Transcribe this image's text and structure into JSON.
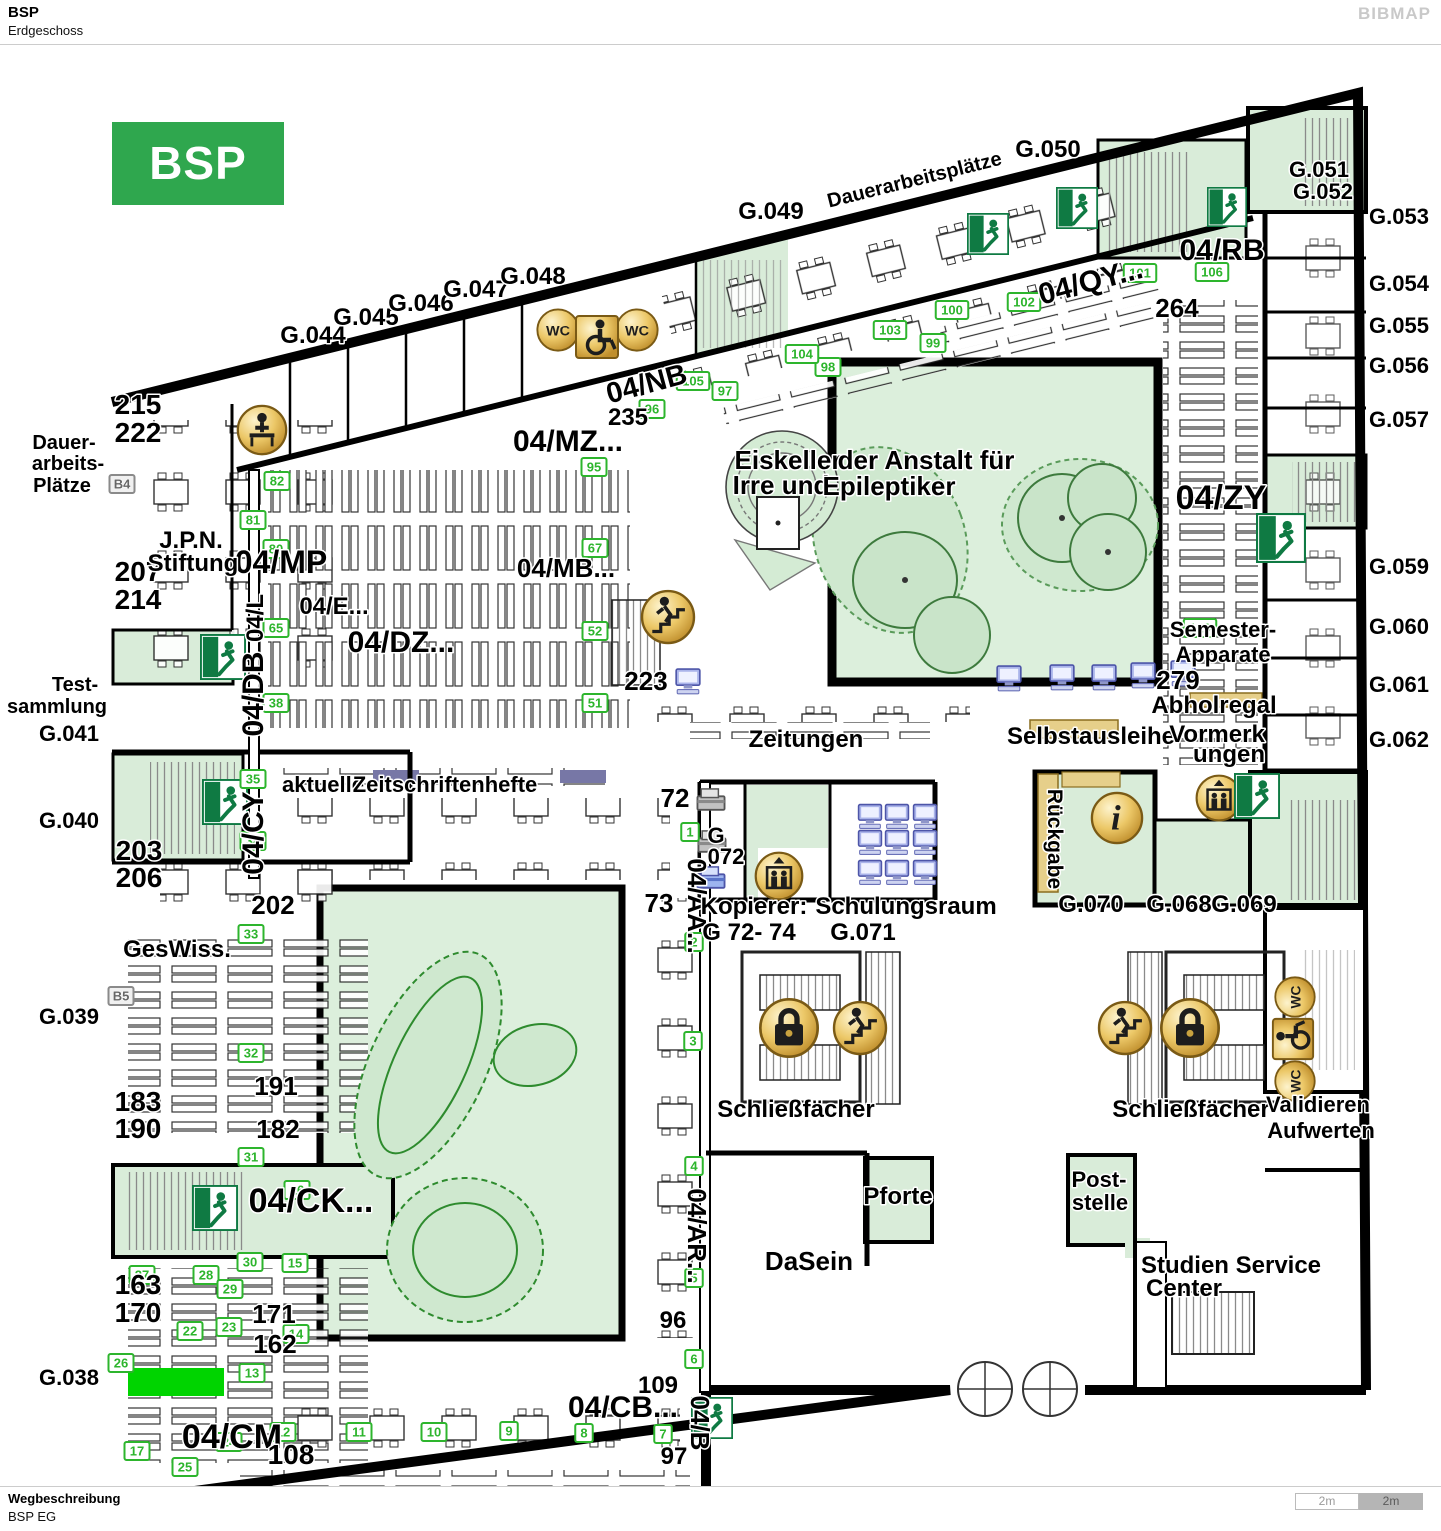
{
  "header": {
    "title": "BSP",
    "subtitle": "Erdgeschoss",
    "brand": "BIBMAP"
  },
  "footer": {
    "label": "Wegbeschreibung",
    "value": "BSP EG",
    "scale_left": "2m",
    "scale_right": "2m"
  },
  "map": {
    "title_box": {
      "text": "BSP EG",
      "color": "#2fa74e"
    },
    "highlight": {
      "x": 128,
      "y": 1368,
      "w": 96,
      "h": 28,
      "color": "#00d400"
    },
    "labels": [
      {
        "t": "G.044",
        "x": 313,
        "y": 343,
        "s": 24
      },
      {
        "t": "G.045",
        "x": 366,
        "y": 325,
        "s": 24
      },
      {
        "t": "G.046",
        "x": 421,
        "y": 311,
        "s": 24
      },
      {
        "t": "G.047",
        "x": 476,
        "y": 297,
        "s": 24
      },
      {
        "t": "G.048",
        "x": 533,
        "y": 284,
        "s": 24
      },
      {
        "t": "G.049",
        "x": 771,
        "y": 219,
        "s": 24
      },
      {
        "t": "Dauerarbeitsplätze",
        "x": 916,
        "y": 186,
        "s": 20,
        "r": -14
      },
      {
        "t": "G.050",
        "x": 1048,
        "y": 157,
        "s": 24
      },
      {
        "t": "G.051",
        "x": 1319,
        "y": 177,
        "s": 22
      },
      {
        "t": "G.052",
        "x": 1323,
        "y": 199,
        "s": 22
      },
      {
        "t": "G.053",
        "x": 1399,
        "y": 224,
        "s": 22
      },
      {
        "t": "G.054",
        "x": 1399,
        "y": 291,
        "s": 22
      },
      {
        "t": "G.055",
        "x": 1399,
        "y": 333,
        "s": 22
      },
      {
        "t": "G.056",
        "x": 1399,
        "y": 373,
        "s": 22
      },
      {
        "t": "G.057",
        "x": 1399,
        "y": 427,
        "s": 22
      },
      {
        "t": "G.059",
        "x": 1399,
        "y": 574,
        "s": 22
      },
      {
        "t": "G.060",
        "x": 1399,
        "y": 634,
        "s": 22
      },
      {
        "t": "G.061",
        "x": 1399,
        "y": 692,
        "s": 22
      },
      {
        "t": "G.062",
        "x": 1399,
        "y": 747,
        "s": 22
      },
      {
        "t": "04/RB",
        "x": 1222,
        "y": 260,
        "s": 30
      },
      {
        "t": "04/QY...",
        "x": 1093,
        "y": 291,
        "s": 30,
        "r": -15
      },
      {
        "t": "264",
        "x": 1177,
        "y": 317,
        "s": 26
      },
      {
        "t": "04/NB",
        "x": 649,
        "y": 393,
        "s": 29,
        "r": -15
      },
      {
        "t": "235",
        "x": 628,
        "y": 425,
        "s": 24
      },
      {
        "t": "04/MZ...",
        "x": 568,
        "y": 451,
        "s": 30
      },
      {
        "t": "04/ZY",
        "x": 1221,
        "y": 509,
        "s": 34
      },
      {
        "t": "04/MP",
        "x": 281,
        "y": 573,
        "s": 32
      },
      {
        "t": "04/MB...",
        "x": 566,
        "y": 577,
        "s": 26
      },
      {
        "t": "04/E...",
        "x": 334,
        "y": 614,
        "s": 24
      },
      {
        "t": "04/DZ...",
        "x": 401,
        "y": 652,
        "s": 30
      },
      {
        "t": "04/CK...",
        "x": 311,
        "y": 1212,
        "s": 34
      },
      {
        "t": "04/CM",
        "x": 232,
        "y": 1448,
        "s": 34
      },
      {
        "t": "04/CB...",
        "x": 623,
        "y": 1417,
        "s": 30
      },
      {
        "t": "04/L",
        "x": 263,
        "y": 618,
        "s": 24,
        "r": -90
      },
      {
        "t": "04/DB",
        "x": 263,
        "y": 694,
        "s": 30,
        "r": -90
      },
      {
        "t": "04/CY",
        "x": 263,
        "y": 833,
        "s": 30,
        "r": -90
      },
      {
        "t": "04/AA...",
        "x": 688,
        "y": 906,
        "s": 26,
        "r": 90
      },
      {
        "t": "04/AR...",
        "x": 688,
        "y": 1236,
        "s": 26,
        "r": 90
      },
      {
        "t": "04/B",
        "x": 691,
        "y": 1423,
        "s": 26,
        "r": 90
      },
      {
        "t": "Rückgabe",
        "x": 1048,
        "y": 839,
        "s": 21,
        "r": 90
      },
      {
        "t": "215",
        "x": 138,
        "y": 414,
        "s": 28
      },
      {
        "t": "222",
        "x": 138,
        "y": 442,
        "s": 28
      },
      {
        "t": "207",
        "x": 138,
        "y": 581,
        "s": 28
      },
      {
        "t": "214",
        "x": 138,
        "y": 609,
        "s": 28
      },
      {
        "t": "203",
        "x": 139,
        "y": 860,
        "s": 28
      },
      {
        "t": "206",
        "x": 139,
        "y": 887,
        "s": 28
      },
      {
        "t": "183",
        "x": 138,
        "y": 1111,
        "s": 28
      },
      {
        "t": "190",
        "x": 138,
        "y": 1138,
        "s": 28
      },
      {
        "t": "163",
        "x": 138,
        "y": 1294,
        "s": 28
      },
      {
        "t": "170",
        "x": 138,
        "y": 1322,
        "s": 28
      },
      {
        "t": "202",
        "x": 273,
        "y": 914,
        "s": 26
      },
      {
        "t": "191",
        "x": 276,
        "y": 1095,
        "s": 26
      },
      {
        "t": "182",
        "x": 278,
        "y": 1138,
        "s": 26
      },
      {
        "t": "171",
        "x": 274,
        "y": 1323,
        "s": 26
      },
      {
        "t": "162",
        "x": 275,
        "y": 1353,
        "s": 26
      },
      {
        "t": "108",
        "x": 291,
        "y": 1464,
        "s": 28
      },
      {
        "t": "109",
        "x": 658,
        "y": 1393,
        "s": 24
      },
      {
        "t": "96",
        "x": 673,
        "y": 1328,
        "s": 24
      },
      {
        "t": "97",
        "x": 674,
        "y": 1464,
        "s": 24
      },
      {
        "t": "72",
        "x": 675,
        "y": 807,
        "s": 26
      },
      {
        "t": "73",
        "x": 659,
        "y": 912,
        "s": 26
      },
      {
        "t": "223",
        "x": 646,
        "y": 690,
        "s": 26
      },
      {
        "t": "279",
        "x": 1178,
        "y": 689,
        "s": 26
      },
      {
        "t": "Dauer-",
        "x": 64,
        "y": 449,
        "s": 20
      },
      {
        "t": "arbeits-",
        "x": 68,
        "y": 470,
        "s": 20
      },
      {
        "t": "Plätze",
        "x": 62,
        "y": 492,
        "s": 20
      },
      {
        "t": "Test-",
        "x": 75,
        "y": 691,
        "s": 20
      },
      {
        "t": "sammlung",
        "x": 57,
        "y": 713,
        "s": 20
      },
      {
        "t": "G.041",
        "x": 69,
        "y": 741,
        "s": 22
      },
      {
        "t": "G.040",
        "x": 69,
        "y": 828,
        "s": 22
      },
      {
        "t": "G.039",
        "x": 69,
        "y": 1024,
        "s": 22
      },
      {
        "t": "G.038",
        "x": 69,
        "y": 1385,
        "s": 22
      },
      {
        "t": "J.P.N.",
        "x": 191,
        "y": 548,
        "s": 24
      },
      {
        "t": "Stiftung",
        "x": 193,
        "y": 571,
        "s": 24
      },
      {
        "t": "Eiskeller",
        "x": 788,
        "y": 469,
        "s": 26
      },
      {
        "t": "Irre und",
        "x": 781,
        "y": 494,
        "s": 26
      },
      {
        "t": "der Anstalt für",
        "x": 926,
        "y": 469,
        "s": 26
      },
      {
        "t": "Epileptiker",
        "x": 889,
        "y": 495,
        "s": 26
      },
      {
        "t": "Zeitungen",
        "x": 806,
        "y": 747,
        "s": 24
      },
      {
        "t": "Selbstausleihe",
        "x": 1091,
        "y": 744,
        "s": 24
      },
      {
        "t": "Abholregal",
        "x": 1214,
        "y": 713,
        "s": 24
      },
      {
        "t": "Vormerk",
        "x": 1217,
        "y": 742,
        "s": 24
      },
      {
        "t": "ungen",
        "x": 1229,
        "y": 762,
        "s": 24
      },
      {
        "t": "Semester-",
        "x": 1223,
        "y": 637,
        "s": 22
      },
      {
        "t": "Apparate",
        "x": 1223,
        "y": 662,
        "s": 22
      },
      {
        "t": "aktuelle",
        "x": 323,
        "y": 792,
        "s": 22
      },
      {
        "t": "Zeitschriftenhefte",
        "x": 445,
        "y": 792,
        "s": 22
      },
      {
        "t": "G",
        "x": 716,
        "y": 843,
        "s": 22
      },
      {
        "t": "072",
        "x": 726,
        "y": 864,
        "s": 22
      },
      {
        "t": "Kopierer:",
        "x": 754,
        "y": 914,
        "s": 24
      },
      {
        "t": "G 72- 74",
        "x": 749,
        "y": 940,
        "s": 24
      },
      {
        "t": "Schulungsraum",
        "x": 906,
        "y": 914,
        "s": 24
      },
      {
        "t": "G.071",
        "x": 863,
        "y": 940,
        "s": 24
      },
      {
        "t": "G.070",
        "x": 1091,
        "y": 912,
        "s": 24
      },
      {
        "t": "G.068",
        "x": 1179,
        "y": 912,
        "s": 24
      },
      {
        "t": "G.069",
        "x": 1244,
        "y": 912,
        "s": 24
      },
      {
        "t": "GesWiss.",
        "x": 177,
        "y": 957,
        "s": 24
      },
      {
        "t": "Schließfächer",
        "x": 796,
        "y": 1117,
        "s": 24
      },
      {
        "t": "Schließfächer",
        "x": 1191,
        "y": 1117,
        "s": 24
      },
      {
        "t": "Validieren",
        "x": 1318,
        "y": 1112,
        "s": 22
      },
      {
        "t": "Aufwerten",
        "x": 1321,
        "y": 1138,
        "s": 22
      },
      {
        "t": "DaSein",
        "x": 809,
        "y": 1270,
        "s": 26
      },
      {
        "t": "Pforte",
        "x": 898,
        "y": 1204,
        "s": 24
      },
      {
        "t": "Post-",
        "x": 1099,
        "y": 1187,
        "s": 22
      },
      {
        "t": "stelle",
        "x": 1100,
        "y": 1210,
        "s": 22
      },
      {
        "t": "Studien Service",
        "x": 1231,
        "y": 1273,
        "s": 24
      },
      {
        "t": "Center",
        "x": 1184,
        "y": 1296,
        "s": 24
      }
    ],
    "markers": [
      {
        "n": "1",
        "x": 690,
        "y": 832
      },
      {
        "n": "2",
        "x": 694,
        "y": 942
      },
      {
        "n": "3",
        "x": 693,
        "y": 1041
      },
      {
        "n": "4",
        "x": 694,
        "y": 1166
      },
      {
        "n": "5",
        "x": 694,
        "y": 1278
      },
      {
        "n": "6",
        "x": 694,
        "y": 1359
      },
      {
        "n": "7",
        "x": 663,
        "y": 1434
      },
      {
        "n": "8",
        "x": 584,
        "y": 1433
      },
      {
        "n": "9",
        "x": 509,
        "y": 1431
      },
      {
        "n": "10",
        "x": 434,
        "y": 1432
      },
      {
        "n": "11",
        "x": 359,
        "y": 1432
      },
      {
        "n": "12",
        "x": 283,
        "y": 1432
      },
      {
        "n": "13",
        "x": 252,
        "y": 1373
      },
      {
        "n": "14",
        "x": 296,
        "y": 1334
      },
      {
        "n": "15",
        "x": 295,
        "y": 1263
      },
      {
        "n": "16",
        "x": 297,
        "y": 1190
      },
      {
        "n": "17",
        "x": 137,
        "y": 1451
      },
      {
        "n": "22",
        "x": 190,
        "y": 1331
      },
      {
        "n": "23",
        "x": 229,
        "y": 1327
      },
      {
        "n": "24",
        "x": 229,
        "y": 1442
      },
      {
        "n": "25",
        "x": 185,
        "y": 1467
      },
      {
        "n": "26",
        "x": 121,
        "y": 1363
      },
      {
        "n": "27",
        "x": 142,
        "y": 1275
      },
      {
        "n": "28",
        "x": 206,
        "y": 1275
      },
      {
        "n": "29",
        "x": 230,
        "y": 1289
      },
      {
        "n": "30",
        "x": 250,
        "y": 1262
      },
      {
        "n": "31",
        "x": 251,
        "y": 1157
      },
      {
        "n": "32",
        "x": 251,
        "y": 1053
      },
      {
        "n": "33",
        "x": 251,
        "y": 934
      },
      {
        "n": "34",
        "x": 253,
        "y": 841
      },
      {
        "n": "35",
        "x": 253,
        "y": 779
      },
      {
        "n": "38",
        "x": 276,
        "y": 703
      },
      {
        "n": "51",
        "x": 595,
        "y": 703
      },
      {
        "n": "52",
        "x": 595,
        "y": 631
      },
      {
        "n": "65",
        "x": 276,
        "y": 628
      },
      {
        "n": "67",
        "x": 595,
        "y": 548
      },
      {
        "n": "80",
        "x": 276,
        "y": 549
      },
      {
        "n": "81",
        "x": 253,
        "y": 520
      },
      {
        "n": "82",
        "x": 277,
        "y": 481
      },
      {
        "n": "95",
        "x": 594,
        "y": 467
      },
      {
        "n": "96",
        "x": 652,
        "y": 409
      },
      {
        "n": "97",
        "x": 725,
        "y": 391
      },
      {
        "n": "98",
        "x": 828,
        "y": 367
      },
      {
        "n": "99",
        "x": 933,
        "y": 343
      },
      {
        "n": "100",
        "x": 952,
        "y": 310
      },
      {
        "n": "101",
        "x": 1140,
        "y": 273
      },
      {
        "n": "102",
        "x": 1024,
        "y": 302
      },
      {
        "n": "103",
        "x": 890,
        "y": 330
      },
      {
        "n": "104",
        "x": 802,
        "y": 354
      },
      {
        "n": "105",
        "x": 693,
        "y": 381
      },
      {
        "n": "106",
        "x": 1212,
        "y": 272
      },
      {
        "n": "120",
        "x": 1200,
        "y": 628
      },
      {
        "n": "B4",
        "x": 122,
        "y": 484,
        "gray": true
      },
      {
        "n": "B5",
        "x": 121,
        "y": 996,
        "gray": true
      }
    ],
    "icons": [
      {
        "type": "wc",
        "x": 558,
        "y": 330,
        "s": 46
      },
      {
        "type": "wc",
        "x": 637,
        "y": 330,
        "s": 46
      },
      {
        "type": "accessible",
        "x": 597,
        "y": 337,
        "s": 48
      },
      {
        "type": "persondesk",
        "x": 262,
        "y": 430,
        "s": 54
      },
      {
        "type": "stairs",
        "x": 668,
        "y": 617,
        "s": 58
      },
      {
        "type": "info",
        "x": 1117,
        "y": 818,
        "s": 56
      },
      {
        "type": "elevator",
        "x": 779,
        "y": 876,
        "s": 52
      },
      {
        "type": "elevator",
        "x": 1219,
        "y": 798,
        "s": 50
      },
      {
        "type": "lock",
        "x": 789,
        "y": 1028,
        "s": 64
      },
      {
        "type": "lock",
        "x": 1190,
        "y": 1028,
        "s": 64
      },
      {
        "type": "stairs",
        "x": 860,
        "y": 1028,
        "s": 58
      },
      {
        "type": "stairs",
        "x": 1125,
        "y": 1028,
        "s": 58
      },
      {
        "type": "wc",
        "x": 1295,
        "y": 997,
        "s": 44,
        "r": -90
      },
      {
        "type": "accessible",
        "x": 1293,
        "y": 1039,
        "s": 46,
        "r": -90
      },
      {
        "type": "wc",
        "x": 1295,
        "y": 1081,
        "s": 44,
        "r": -90
      },
      {
        "type": "exit",
        "x": 988,
        "y": 234,
        "s": 42
      },
      {
        "type": "exit",
        "x": 1077,
        "y": 208,
        "s": 42
      },
      {
        "type": "exit",
        "x": 1227,
        "y": 207,
        "s": 40
      },
      {
        "type": "exit",
        "x": 223,
        "y": 657,
        "s": 46
      },
      {
        "type": "exit",
        "x": 225,
        "y": 802,
        "s": 46
      },
      {
        "type": "exit",
        "x": 1281,
        "y": 538,
        "s": 50
      },
      {
        "type": "exit",
        "x": 1257,
        "y": 796,
        "s": 46
      },
      {
        "type": "exit",
        "x": 215,
        "y": 1208,
        "s": 46
      },
      {
        "type": "exit",
        "x": 712,
        "y": 1418,
        "s": 42
      },
      {
        "type": "computer",
        "x": 688,
        "y": 682,
        "s": 28
      },
      {
        "type": "computer",
        "x": 1009,
        "y": 679,
        "s": 28
      },
      {
        "type": "computer",
        "x": 1062,
        "y": 678,
        "s": 28
      },
      {
        "type": "computer",
        "x": 1104,
        "y": 678,
        "s": 28
      },
      {
        "type": "computer",
        "x": 1143,
        "y": 676,
        "s": 28
      },
      {
        "type": "computer",
        "x": 1183,
        "y": 674,
        "s": 28
      },
      {
        "type": "computer",
        "x": 870,
        "y": 817,
        "s": 27
      },
      {
        "type": "computer",
        "x": 897,
        "y": 817,
        "s": 27
      },
      {
        "type": "computer",
        "x": 925,
        "y": 817,
        "s": 27
      },
      {
        "type": "computer",
        "x": 870,
        "y": 843,
        "s": 27
      },
      {
        "type": "computer",
        "x": 897,
        "y": 843,
        "s": 27
      },
      {
        "type": "computer",
        "x": 925,
        "y": 843,
        "s": 27
      },
      {
        "type": "computer",
        "x": 870,
        "y": 873,
        "s": 27
      },
      {
        "type": "computer",
        "x": 897,
        "y": 873,
        "s": 27
      },
      {
        "type": "computer",
        "x": 925,
        "y": 873,
        "s": 27
      },
      {
        "type": "copier",
        "x": 711,
        "y": 800,
        "s": 32
      },
      {
        "type": "copier",
        "x": 712,
        "y": 842,
        "s": 32
      },
      {
        "type": "copierblue",
        "x": 711,
        "y": 878,
        "s": 32
      }
    ]
  }
}
